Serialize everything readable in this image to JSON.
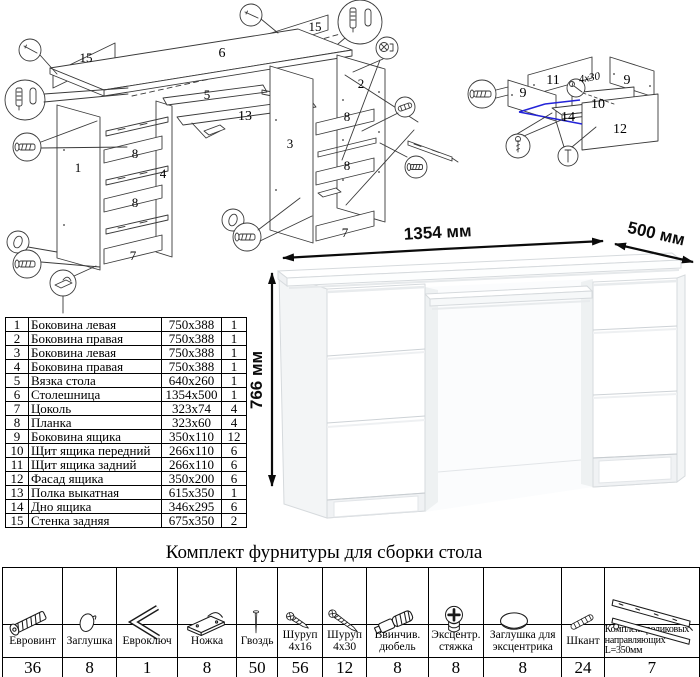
{
  "diagram_left": {
    "labels": {
      "p15a": "15",
      "p6": "6",
      "p15b": "15",
      "p5": "5",
      "p13": "13",
      "p1": "1",
      "p8a": "8",
      "p4": "4",
      "p8b": "8",
      "p7a": "7",
      "p3": "3",
      "p2": "2",
      "p8c": "8",
      "p8d": "8",
      "p7b": "7"
    }
  },
  "diagram_right": {
    "labels": {
      "p11": "11",
      "p9a": "9",
      "p9b": "9",
      "p10": "10",
      "p14": "14",
      "p12": "12"
    },
    "annotation": "4x30",
    "highlight_color": "#2323d8"
  },
  "desk": {
    "width_label": "1354 мм",
    "depth_label": "500 мм",
    "height_label": "766 мм"
  },
  "parts": {
    "rows": [
      {
        "num": "1",
        "name": "Боковина левая",
        "size": "750x388",
        "qty": "1"
      },
      {
        "num": "2",
        "name": "Боковина правая",
        "size": "750x388",
        "qty": "1"
      },
      {
        "num": "3",
        "name": "Боковина левая",
        "size": "750x388",
        "qty": "1"
      },
      {
        "num": "4",
        "name": "Боковина правая",
        "size": "750x388",
        "qty": "1"
      },
      {
        "num": "5",
        "name": "Вязка стола",
        "size": "640x260",
        "qty": "1"
      },
      {
        "num": "6",
        "name": "Столешница",
        "size": "1354x500",
        "qty": "1"
      },
      {
        "num": "7",
        "name": "Цоколь",
        "size": "323x74",
        "qty": "4"
      },
      {
        "num": "8",
        "name": "Планка",
        "size": "323x60",
        "qty": "4"
      },
      {
        "num": "9",
        "name": "Боковина ящика",
        "size": "350x110",
        "qty": "12"
      },
      {
        "num": "10",
        "name": "Щит ящика передний",
        "size": "266x110",
        "qty": "6"
      },
      {
        "num": "11",
        "name": "Щит ящика задний",
        "size": "266x110",
        "qty": "6"
      },
      {
        "num": "12",
        "name": "Фасад ящика",
        "size": "350x200",
        "qty": "6"
      },
      {
        "num": "13",
        "name": "Полка выкатная",
        "size": "615x350",
        "qty": "1"
      },
      {
        "num": "14",
        "name": "Дно ящика",
        "size": "346x295",
        "qty": "6"
      },
      {
        "num": "15",
        "name": "Стенка задняя",
        "size": "675x350",
        "qty": "2"
      }
    ]
  },
  "hardware": {
    "title": "Комплект фурнитуры для сборки стола",
    "items": [
      {
        "name": "Евровинт",
        "qty": "36",
        "icon": "euro-screw-icon"
      },
      {
        "name": "Заглушка",
        "qty": "8",
        "icon": "cap-icon"
      },
      {
        "name": "Евроключ",
        "qty": "1",
        "icon": "hex-key-icon"
      },
      {
        "name": "Ножка",
        "qty": "8",
        "icon": "foot-icon"
      },
      {
        "name": "Гвоздь",
        "qty": "50",
        "icon": "nail-icon"
      },
      {
        "name": "Шуруп 4x16",
        "qty": "56",
        "icon": "screw-short-icon"
      },
      {
        "name": "Шуруп 4x30",
        "qty": "12",
        "icon": "screw-long-icon"
      },
      {
        "name": "Ввинчив. дюбель",
        "qty": "8",
        "icon": "dowel-screw-icon"
      },
      {
        "name": "Эксцентр. стяжка",
        "qty": "8",
        "icon": "cam-lock-icon"
      },
      {
        "name": "Заглушка для эксцентрика",
        "qty": "8",
        "icon": "cam-cap-icon"
      },
      {
        "name": "Шкант",
        "qty": "24",
        "icon": "wood-dowel-icon"
      },
      {
        "name": "Комплект роликовых направляющих L=350мм",
        "qty": "7",
        "icon": "drawer-slides-icon"
      }
    ]
  }
}
